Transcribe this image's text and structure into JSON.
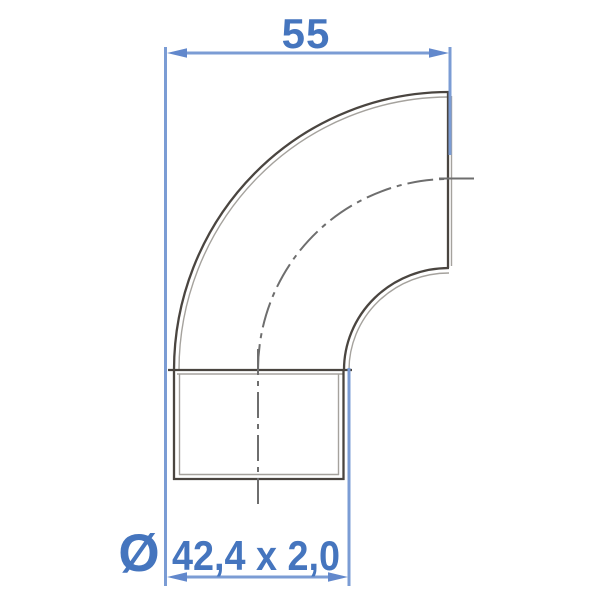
{
  "dimensions": {
    "top": {
      "label": "55"
    },
    "bottom": {
      "symbol": "Ø",
      "label": "42,4 x 2,0"
    }
  },
  "colors": {
    "background": "#ffffff",
    "dim_line": "#7b9cd4",
    "dim_arrow": "#6288cc",
    "dim_text": "#4575be",
    "outline_dark": "#4a4540",
    "outline_light": "#a5a29d",
    "centerline": "#6e6e6e"
  }
}
